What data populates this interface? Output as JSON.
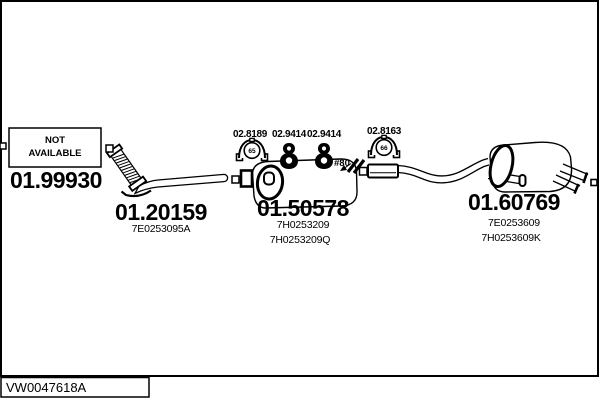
{
  "colors": {
    "ink": "#000000",
    "paper": "#ffffff"
  },
  "diagram": {
    "code": "VW0047618A",
    "not_available": {
      "line1": "NOT",
      "line2": "AVAILABLE",
      "part_number": "01.99930"
    },
    "annotation": "#80",
    "parts": [
      {
        "name": "front-pipe",
        "number": "01.20159",
        "oem": [
          "7E0253095A"
        ]
      },
      {
        "name": "center-muffler",
        "number": "01.50578",
        "oem": [
          "7H0253209",
          "7H0253209Q"
        ]
      },
      {
        "name": "rear-muffler",
        "number": "01.60769",
        "oem": [
          "7E0253609",
          "7H0253609K"
        ]
      }
    ],
    "fittings": [
      {
        "number": "02.8189",
        "type": "clamp",
        "diameter": "65"
      },
      {
        "number": "02.9414",
        "type": "hanger"
      },
      {
        "number": "02.9414",
        "type": "hanger"
      },
      {
        "number": "02.8163",
        "type": "clamp",
        "diameter": "66"
      }
    ]
  }
}
